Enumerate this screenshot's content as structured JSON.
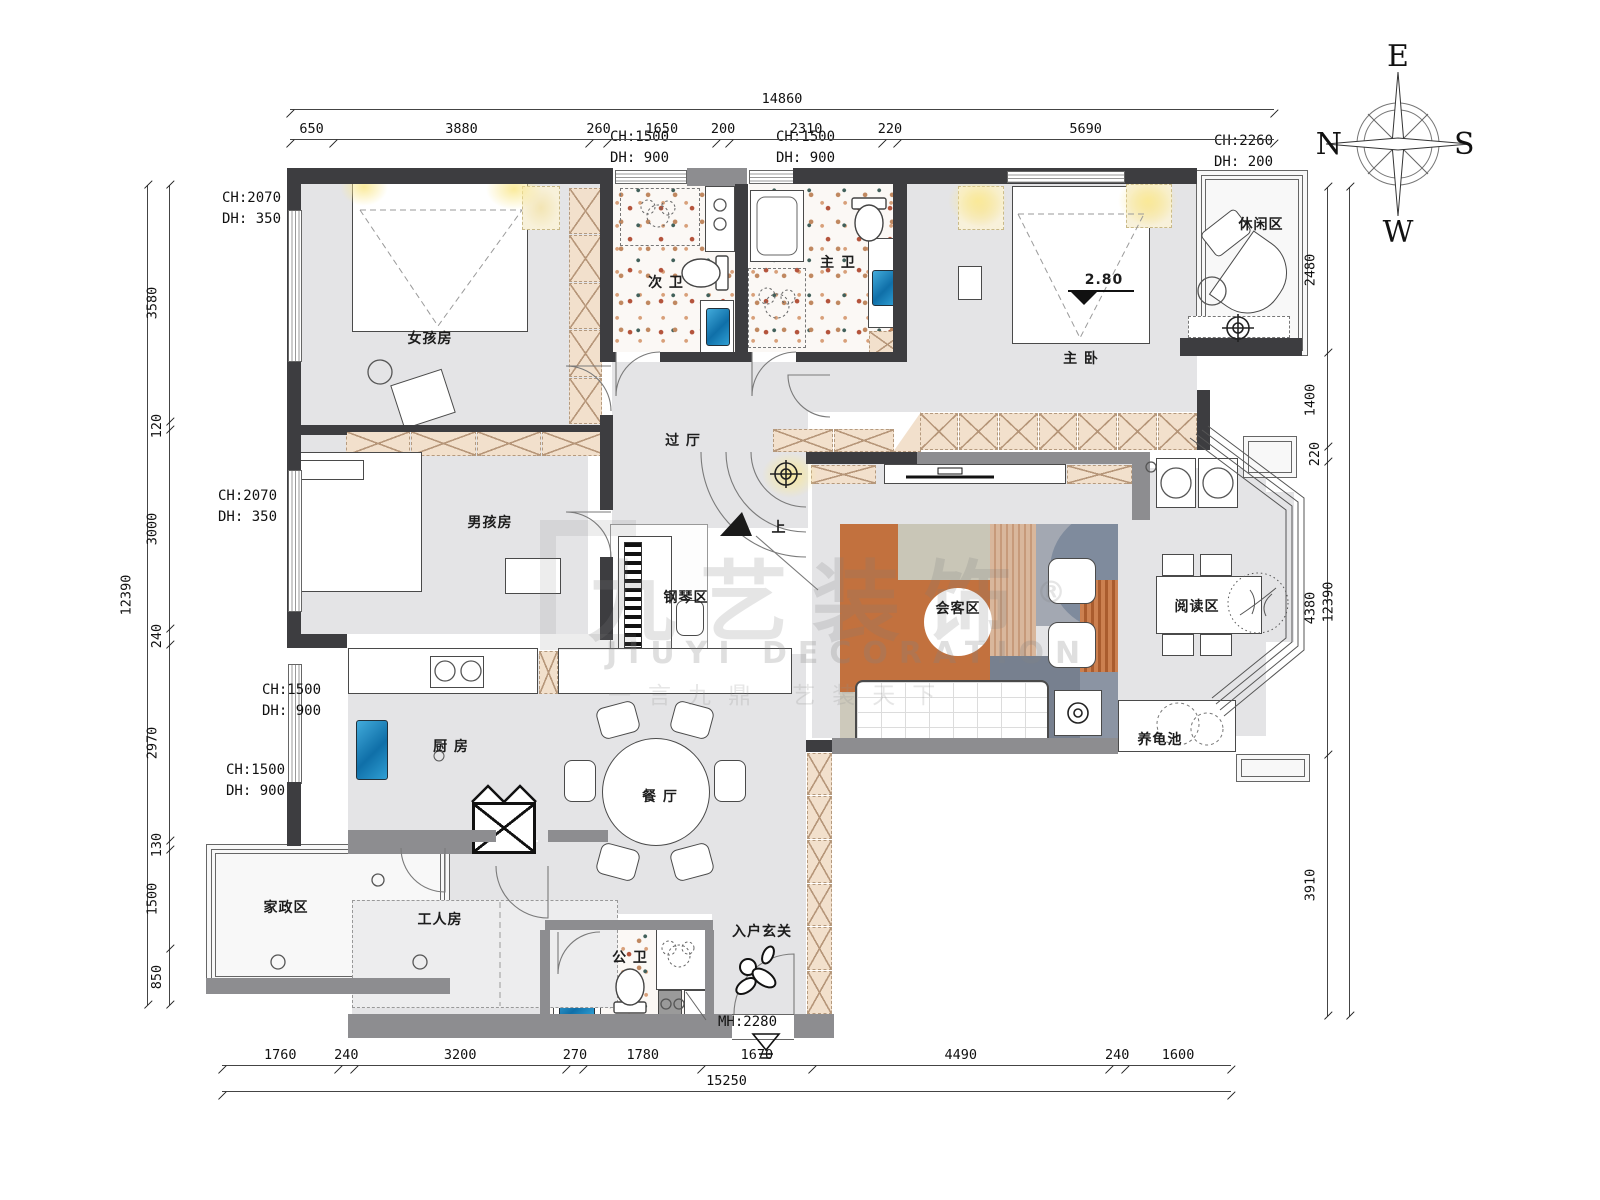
{
  "compass": {
    "top": "E",
    "left": "N",
    "right": "S",
    "bottom": "W"
  },
  "watermark": {
    "brand": "九艺装饰",
    "reg": "®",
    "latin": "JIUYI DECORATION",
    "slogan": "一言九鼎 艺装天下"
  },
  "rooms": [
    {
      "label": "女孩房",
      "x": 430,
      "y": 338
    },
    {
      "label": "男孩房",
      "x": 490,
      "y": 522
    },
    {
      "label": "次 卫",
      "x": 666,
      "y": 282
    },
    {
      "label": "主 卫",
      "x": 838,
      "y": 262
    },
    {
      "label": "主 卧",
      "x": 1081,
      "y": 358
    },
    {
      "label": "休闲区",
      "x": 1261,
      "y": 224
    },
    {
      "label": "过 厅",
      "x": 683,
      "y": 440
    },
    {
      "label": "上",
      "x": 779,
      "y": 527
    },
    {
      "label": "钢琴区",
      "x": 686,
      "y": 597
    },
    {
      "label": "会客区",
      "x": 958,
      "y": 608
    },
    {
      "label": "阅读区",
      "x": 1197,
      "y": 606
    },
    {
      "label": "养龟池",
      "x": 1160,
      "y": 739
    },
    {
      "label": "厨 房",
      "x": 451,
      "y": 746
    },
    {
      "label": "餐 厅",
      "x": 660,
      "y": 796
    },
    {
      "label": "家政区",
      "x": 286,
      "y": 907
    },
    {
      "label": "工人房",
      "x": 440,
      "y": 919
    },
    {
      "label": "公 卫",
      "x": 630,
      "y": 957
    },
    {
      "label": "入户玄关",
      "x": 762,
      "y": 931
    },
    {
      "label": "2.80",
      "x": 1104,
      "y": 280
    }
  ],
  "annotations": [
    {
      "x": 610,
      "y": 127,
      "lines": [
        "CH:1500",
        "DH: 900"
      ]
    },
    {
      "x": 776,
      "y": 127,
      "lines": [
        "CH:1500",
        "DH: 900"
      ]
    },
    {
      "x": 1214,
      "y": 131,
      "lines": [
        "CH:2260",
        "DH: 200"
      ]
    },
    {
      "x": 222,
      "y": 188,
      "lines": [
        "CH:2070",
        "DH: 350"
      ]
    },
    {
      "x": 218,
      "y": 486,
      "lines": [
        "CH:2070",
        "DH: 350"
      ]
    },
    {
      "x": 262,
      "y": 680,
      "lines": [
        "CH:1500",
        "DH: 900"
      ]
    },
    {
      "x": 226,
      "y": 760,
      "lines": [
        "CH:1500",
        "DH: 900"
      ]
    },
    {
      "x": 718,
      "y": 1012,
      "lines": [
        "MH:2280"
      ]
    }
  ],
  "dimensions": {
    "top": {
      "total": 14860,
      "segments": [
        650,
        3880,
        260,
        1650,
        200,
        2310,
        220,
        5690
      ]
    },
    "bottom": {
      "total": 15250,
      "segments": [
        1760,
        240,
        3200,
        270,
        1780,
        1670,
        4490,
        240,
        1600
      ]
    },
    "left": {
      "total": 12390,
      "segments": [
        3580,
        120,
        3000,
        240,
        2970,
        130,
        1500,
        850
      ]
    },
    "right": {
      "total": 12390,
      "segments": [
        2480,
        1400,
        220,
        4380,
        3910
      ]
    }
  }
}
